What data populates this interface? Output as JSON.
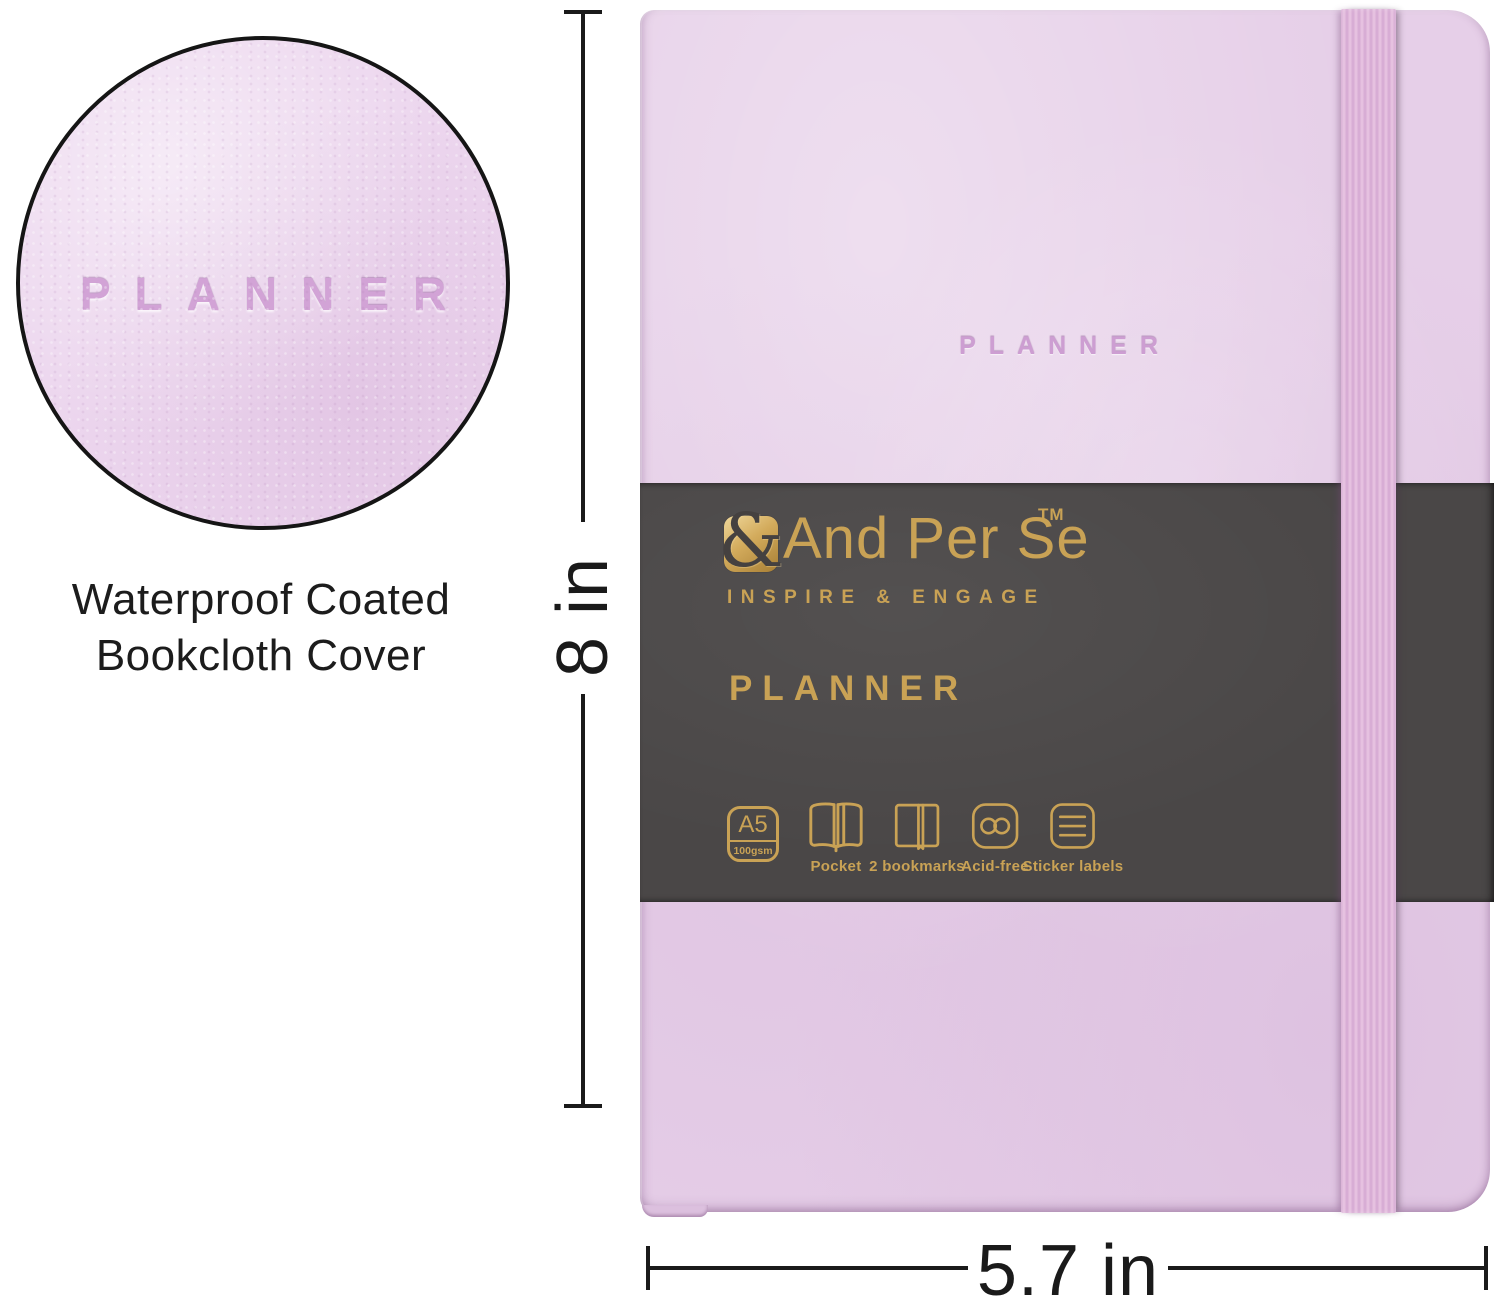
{
  "detail_view": {
    "embossed_text": "PLANNER",
    "caption": [
      "Waterproof Coated",
      "Bookcloth Cover"
    ]
  },
  "measurements": {
    "height": "8 in",
    "width": "5.7 in"
  },
  "notebook": {
    "cover_embossed_text": "PLANNER",
    "band": {
      "logo_ampersand": "&",
      "brand_name": "And Per Se",
      "trademark": "TM",
      "tagline": "INSPIRE & ENGAGE",
      "product_name": "PLANNER",
      "features": [
        {
          "icon": "a5-size-icon",
          "size_label": "A5",
          "weight_label": "100gsm"
        },
        {
          "icon": "pocket-icon",
          "label": "Pocket"
        },
        {
          "icon": "two-bookmarks-icon",
          "label": "2 bookmarks"
        },
        {
          "icon": "acid-free-icon",
          "label": "Acid-free"
        },
        {
          "icon": "sticker-labels-icon",
          "label": "Sticker labels"
        }
      ]
    }
  },
  "colors": {
    "cover_lavender": "#e6cfe8",
    "detail_circle_fill": "#ecd6ee",
    "elastic_pink": "#dcb1d8",
    "band_charcoal": "#4a4747",
    "gold_foil": "#c9a255",
    "emboss_mauve": "#cd9ed2",
    "dimension_line": "#1a1a1a"
  }
}
